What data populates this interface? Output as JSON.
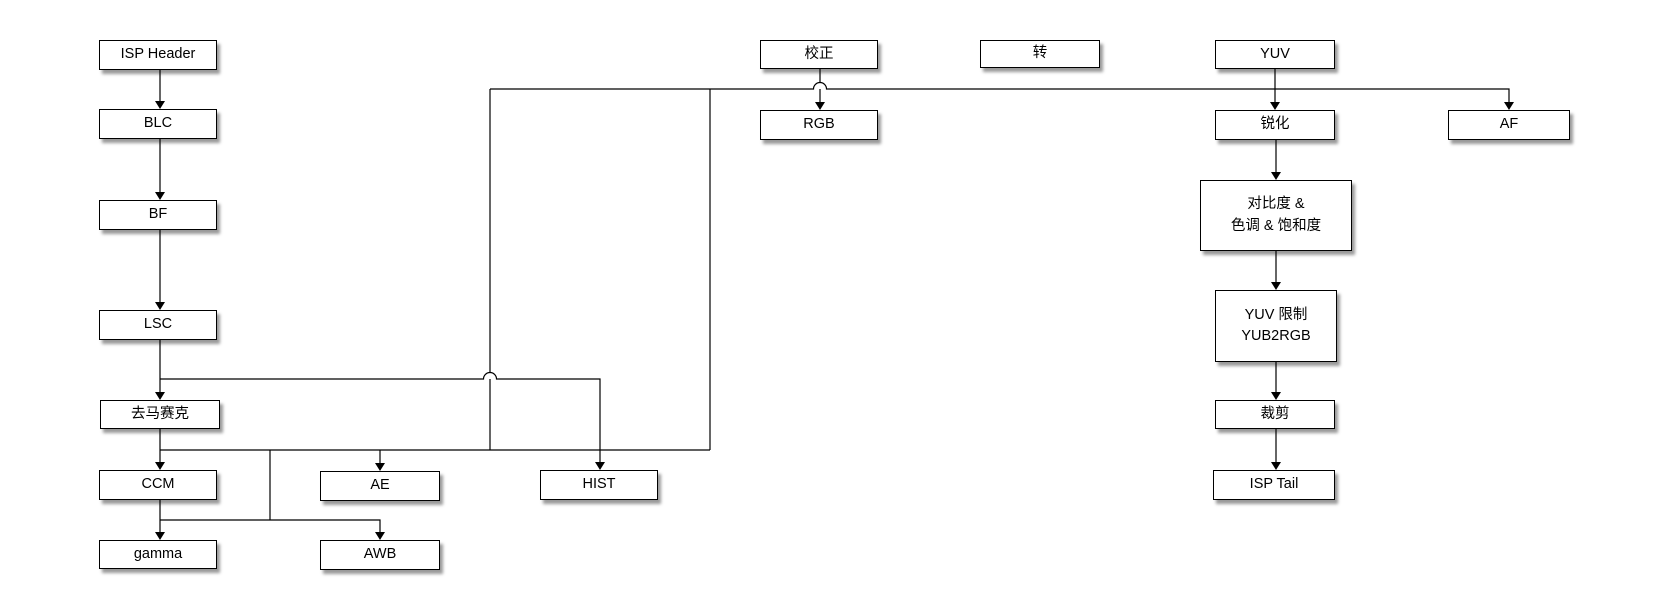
{
  "diagram": {
    "title": "ISP pipeline flowchart",
    "background_color": "#ffffff",
    "box_fill_color": "#ffffff",
    "box_border_color": "#000000",
    "line_color": "#000000",
    "text_color": "#000000"
  },
  "nodes": [
    {
      "id": "isp-header",
      "label": "ISP Header"
    },
    {
      "id": "blc",
      "label": "BLC"
    },
    {
      "id": "bf",
      "label": "BF"
    },
    {
      "id": "lsc",
      "label": "LSC"
    },
    {
      "id": "demosaic",
      "label": "去马赛克"
    },
    {
      "id": "ccm",
      "label": "CCM"
    },
    {
      "id": "gamma",
      "label": "gamma"
    },
    {
      "id": "ae",
      "label": "AE"
    },
    {
      "id": "awb",
      "label": "AWB"
    },
    {
      "id": "hist",
      "label": "HIST"
    },
    {
      "id": "correction",
      "label": "校正"
    },
    {
      "id": "rgb",
      "label": "RGB"
    },
    {
      "id": "convert",
      "label": "转"
    },
    {
      "id": "yuv",
      "label": "YUV"
    },
    {
      "id": "sharpen",
      "label": "锐化"
    },
    {
      "id": "contrast",
      "label": "对比度 &",
      "label2": "色调 & 饱和度"
    },
    {
      "id": "yuv-limit",
      "label": "YUV 限制",
      "label2": "YUB2RGB"
    },
    {
      "id": "crop",
      "label": "裁剪"
    },
    {
      "id": "isp-tail",
      "label": "ISP Tail"
    },
    {
      "id": "af",
      "label": "AF"
    }
  ],
  "edges": [
    {
      "from": "isp-header",
      "to": "blc"
    },
    {
      "from": "blc",
      "to": "bf"
    },
    {
      "from": "bf",
      "to": "lsc"
    },
    {
      "from": "lsc",
      "to": "demosaic"
    },
    {
      "from": "lsc",
      "to": "hist"
    },
    {
      "from": "demosaic",
      "to": "ccm"
    },
    {
      "from": "demosaic",
      "to": "ae"
    },
    {
      "from": "demosaic",
      "to": "sharpen"
    },
    {
      "from": "demosaic",
      "to": "af"
    },
    {
      "from": "ccm",
      "to": "gamma"
    },
    {
      "from": "ccm",
      "to": "awb"
    },
    {
      "from": "correction",
      "to": "rgb"
    },
    {
      "from": "yuv",
      "to": "sharpen"
    },
    {
      "from": "sharpen",
      "to": "contrast"
    },
    {
      "from": "contrast",
      "to": "yuv-limit"
    },
    {
      "from": "yuv-limit",
      "to": "crop"
    },
    {
      "from": "crop",
      "to": "isp-tail"
    }
  ]
}
